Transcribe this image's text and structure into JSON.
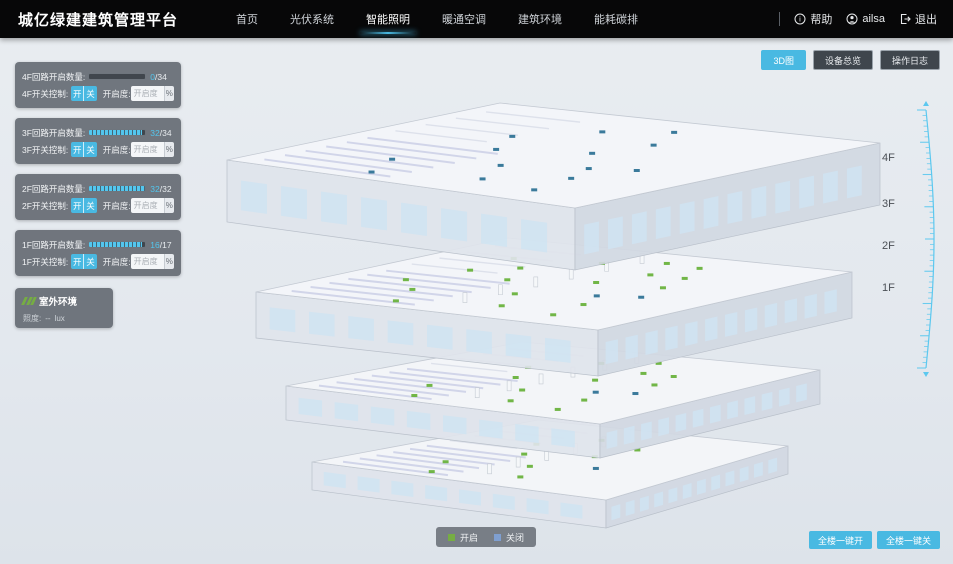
{
  "header": {
    "title": "城亿绿建建筑管理平台",
    "nav": [
      {
        "label": "首页",
        "active": false
      },
      {
        "label": "光伏系统",
        "active": false
      },
      {
        "label": "智能照明",
        "active": true
      },
      {
        "label": "暖通空调",
        "active": false
      },
      {
        "label": "建筑环境",
        "active": false
      },
      {
        "label": "能耗碳排",
        "active": false
      }
    ],
    "help_label": "帮助",
    "user_name": "ailsa",
    "logout_label": "退出"
  },
  "view_buttons": [
    {
      "label": "3D图",
      "active": true
    },
    {
      "label": "设备总览",
      "active": false
    },
    {
      "label": "操作日志",
      "active": false
    }
  ],
  "floor_panels": [
    {
      "floor": "4F",
      "count_label": "4F回路开启数量:",
      "on": 0,
      "total": 34,
      "on_text": "0",
      "total_text": "/34",
      "switch_label": "4F开关控制:",
      "on_btn": "开",
      "off_btn": "关",
      "dim_label": "开启度:",
      "dim_placeholder": "开启度",
      "percent_label": "%"
    },
    {
      "floor": "3F",
      "count_label": "3F回路开启数量:",
      "on": 32,
      "total": 34,
      "on_text": "32",
      "total_text": "/34",
      "switch_label": "3F开关控制:",
      "on_btn": "开",
      "off_btn": "关",
      "dim_label": "开启度:",
      "dim_placeholder": "开启度",
      "percent_label": "%"
    },
    {
      "floor": "2F",
      "count_label": "2F回路开启数量:",
      "on": 32,
      "total": 32,
      "on_text": "32",
      "total_text": "/32",
      "switch_label": "2F开关控制:",
      "on_btn": "开",
      "off_btn": "关",
      "dim_label": "开启度:",
      "dim_placeholder": "开启度",
      "percent_label": "%"
    },
    {
      "floor": "1F",
      "count_label": "1F回路开启数量:",
      "on": 16,
      "total": 17,
      "on_text": "16",
      "total_text": "/17",
      "switch_label": "1F开关控制:",
      "on_btn": "开",
      "off_btn": "关",
      "dim_label": "开启度:",
      "dim_placeholder": "开启度",
      "percent_label": "%"
    }
  ],
  "outdoor_panel": {
    "title": "室外环境",
    "metric_label": "照度:",
    "metric_value": "--",
    "metric_unit": "lux"
  },
  "floor_marks": [
    {
      "label": "4F",
      "top": 152
    },
    {
      "label": "3F",
      "top": 198
    },
    {
      "label": "2F",
      "top": 240
    },
    {
      "label": "1F",
      "top": 282
    }
  ],
  "legend": {
    "on_label": "开启",
    "off_label": "关闭",
    "on_color": "#76ad43",
    "off_color": "#7f9fd0"
  },
  "bottom_buttons": [
    {
      "label": "全楼一键开"
    },
    {
      "label": "全楼一键关"
    }
  ],
  "colors": {
    "accent": "#49b9e2",
    "progress_fill": "#53c6ee",
    "lamp_on": "#69b23d",
    "lamp_off": "#2f7396",
    "ruler": "#5cc8ef"
  }
}
